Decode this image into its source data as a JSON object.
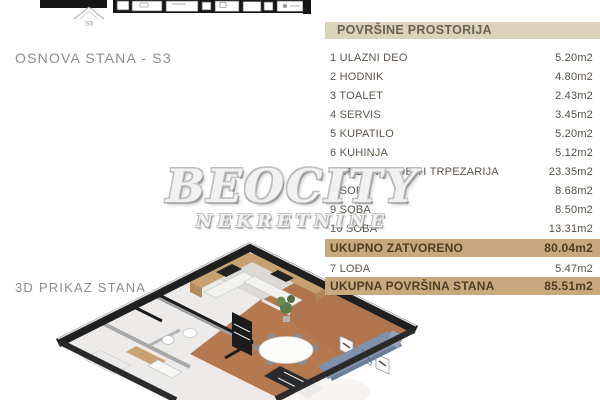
{
  "labels": {
    "plan2d_title": "OSNOVA STANA - S3",
    "plan3d_title": "3D PRIKAZ STANA",
    "unit_marker": "S3"
  },
  "watermark": {
    "line1": "BEOCITY",
    "line2": "NEKRETNINE"
  },
  "table": {
    "title": "POVRŠINE PROSTORIJA",
    "rows": [
      {
        "label": "1 ULAZNI DEO",
        "value": "5.20m2"
      },
      {
        "label": "2 HODNIK",
        "value": "4.80m2"
      },
      {
        "label": "3 TOALET",
        "value": "2.43m2"
      },
      {
        "label": "4 SERVIS",
        "value": "3.45m2"
      },
      {
        "label": "5 KUPATILO",
        "value": "5.20m2"
      },
      {
        "label": "6 KUHINJA",
        "value": "5.12m2"
      },
      {
        "label": "7 DNEVNA SOBA I TRPEZARIJA",
        "value": "23.35m2"
      },
      {
        "label": "8 SOBA",
        "value": "8.68m2"
      },
      {
        "label": "9 SOBA",
        "value": "8.50m2"
      },
      {
        "label": "10 SOBA",
        "value": "13.31m2"
      }
    ],
    "total_closed": {
      "label": "UKUPNO ZATVORENO",
      "value": "80.04m2"
    },
    "loggia": {
      "label": "7 LOĐA",
      "value": "5.47m2"
    },
    "total_area": {
      "label": "UKUPNA POVRŠINA STANA",
      "value": "85.51m2"
    }
  },
  "colors": {
    "header_bg": "#dcd2ba",
    "highlight_bg": "#c8a97d",
    "row_text": "#5c564b",
    "highlight_text": "#4e3d27",
    "section_label_text": "#8d8d8d",
    "watermark_outline": "#b0b0b0",
    "wall_dark": "#1f1f1f",
    "base_floor": "#ecebe9",
    "kitchen_floor": "#dcdad6",
    "wood_floor": "#b5794f",
    "cabinet_wood": "#c9a171",
    "sofa": "#8191ac",
    "sofa_back": "#6c7d99",
    "plant": "#5d7d4a"
  }
}
